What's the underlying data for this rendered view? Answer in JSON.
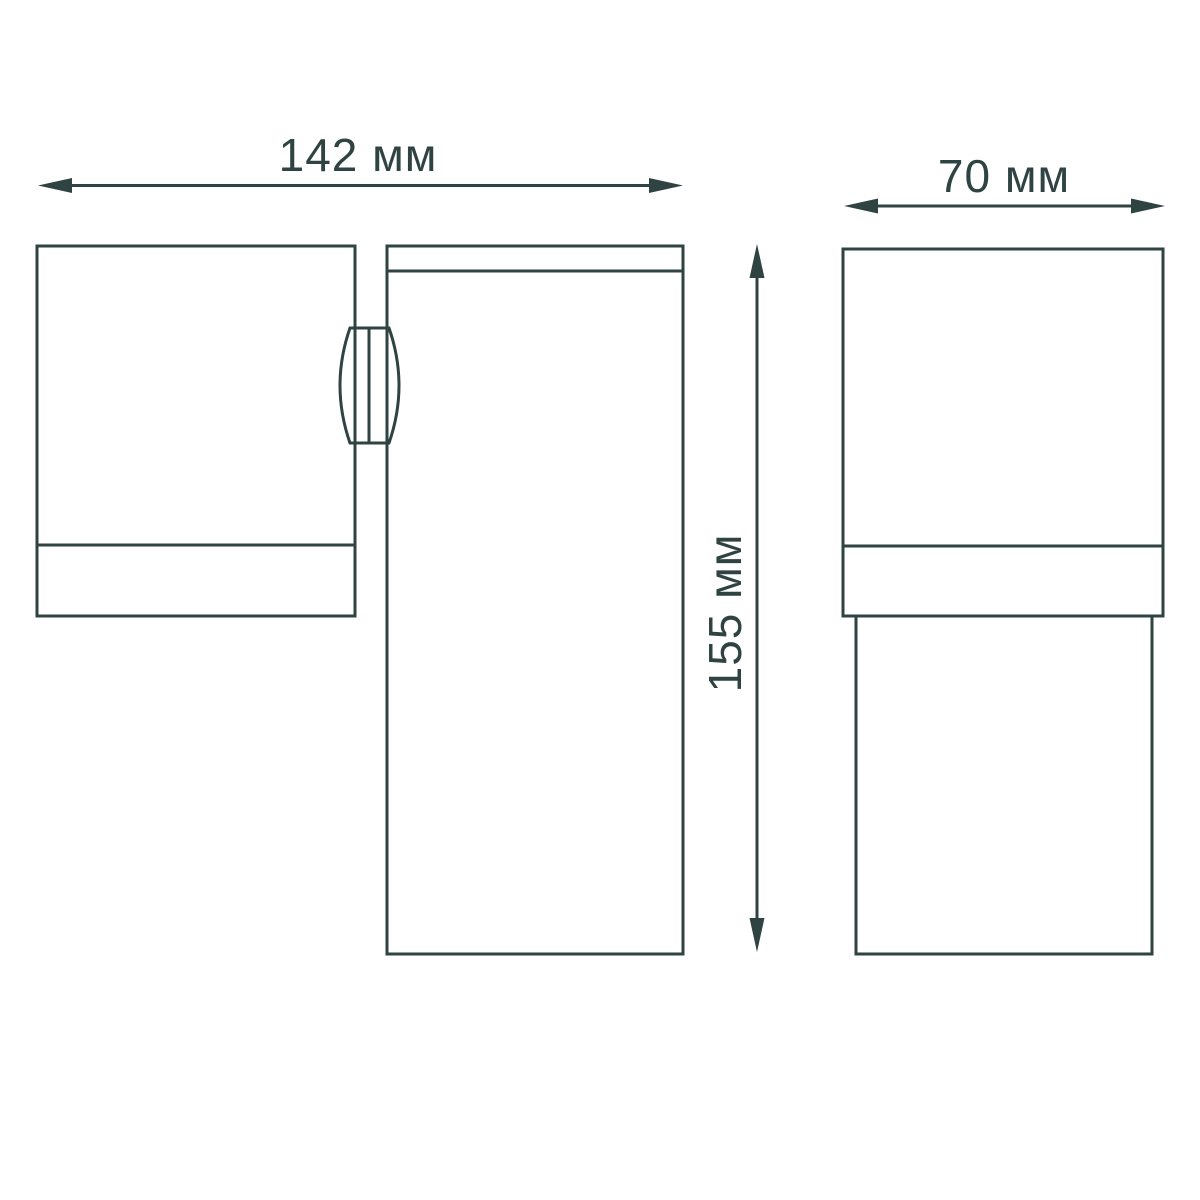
{
  "page": {
    "background": "#ffffff"
  },
  "drawing": {
    "stroke_color": "#2e4342",
    "type": "dimension-drawing",
    "dimensions": {
      "width": {
        "label": "142 мм",
        "value": 142,
        "unit": "мм"
      },
      "height": {
        "label": "155 мм",
        "value": 155,
        "unit": "мм"
      },
      "depth": {
        "label": "70 мм",
        "value": 70,
        "unit": "мм"
      }
    }
  }
}
